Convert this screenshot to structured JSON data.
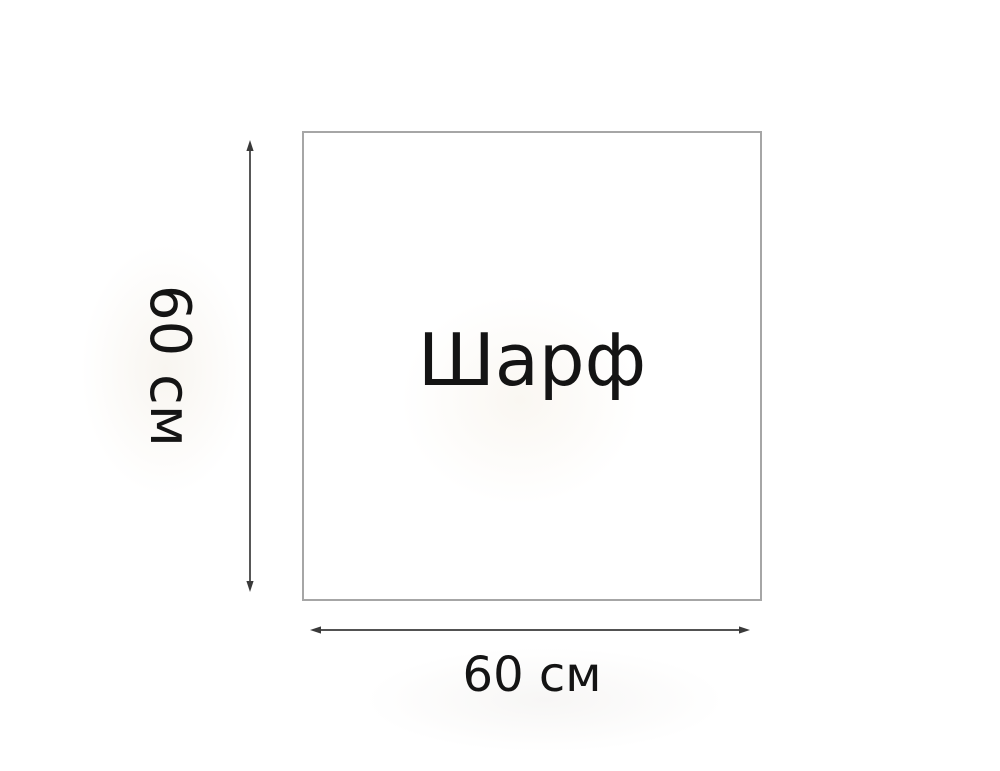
{
  "diagram": {
    "item_label": "Шарф",
    "height_dimension": {
      "label": "60 см"
    },
    "width_dimension": {
      "label": "60 см"
    },
    "colors": {
      "background": "#ffffff",
      "square_border": "#a6a6a6",
      "arrow": "#3a3a3a",
      "text": "#141414"
    }
  }
}
